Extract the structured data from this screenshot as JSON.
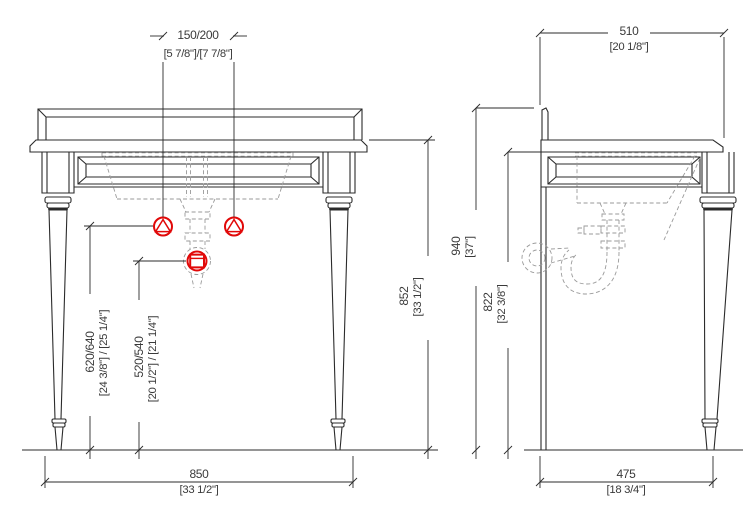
{
  "colors": {
    "ink": "#2b2b2b",
    "hidden": "#9a9a9a",
    "accent": "#e10808",
    "text": "#3a3a3a",
    "background": "#ffffff"
  },
  "drawing": {
    "subject": "console-washstand-two-views",
    "symbols": {
      "water_supply": "circle-with-triangle",
      "waste_outlet": "circle-with-square"
    }
  },
  "dimensions": {
    "faucet_spacing": {
      "mm": "150/200",
      "inch": "[5 7/8\"]/[7 7/8\"]"
    },
    "counter_depth": {
      "mm": "510",
      "inch": "[20 1/8\"]"
    },
    "supply_height": {
      "mm": "620/640",
      "inch": "[24 3/8\"] / [25 1/4\"]"
    },
    "drain_height": {
      "mm": "520/540",
      "inch": "[20 1/2\"] / [21 1/4\"]"
    },
    "counter_height": {
      "mm": "852",
      "inch": "[33 1/2\"]"
    },
    "total_height": {
      "mm": "940",
      "inch": "[37\"]"
    },
    "underside_height": {
      "mm": "822",
      "inch": "[32 3/8\"]"
    },
    "overall_width": {
      "mm": "850",
      "inch": "[33 1/2\"]"
    },
    "leg_depth": {
      "mm": "475",
      "inch": "[18 3/4\"]"
    }
  }
}
